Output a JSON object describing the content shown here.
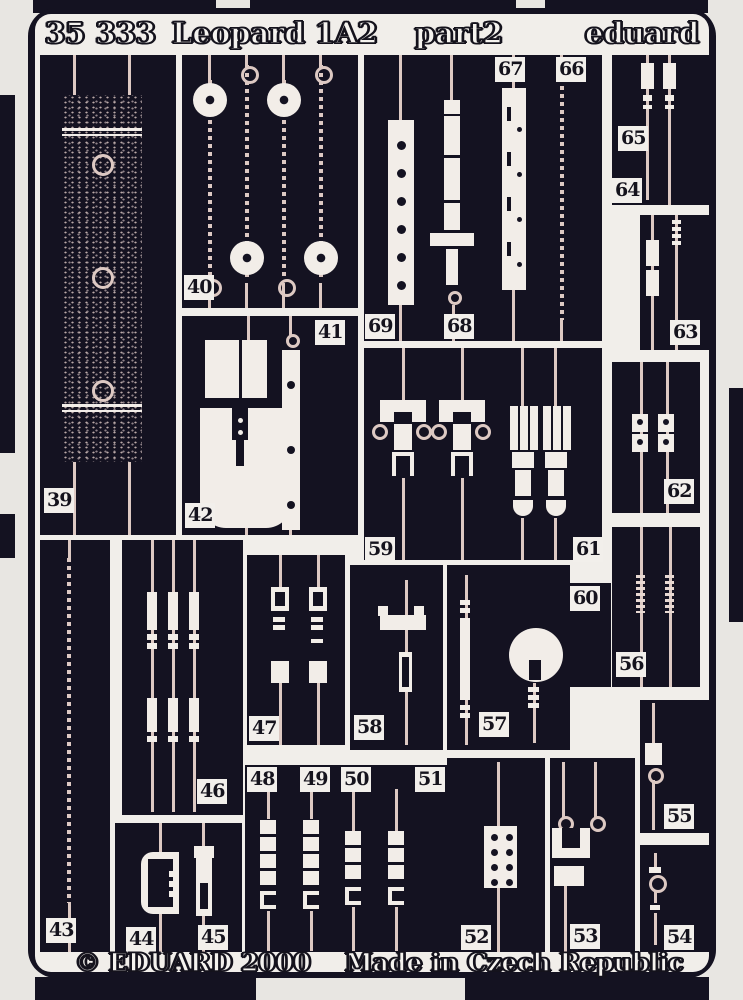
{
  "header": {
    "catalog_number": "35 333",
    "kit_name": "Leopard 1A2",
    "part_label": "part2",
    "brand": "eduard"
  },
  "footer": {
    "copyright": "© EDUARD 2000",
    "origin": "Made in Czech Republic"
  },
  "colors": {
    "fret_dark": "#141221",
    "cutout_white": "#f1eeea",
    "metal_tint": "#ddc9c3",
    "background": "#e8e6e2"
  },
  "parts": {
    "p39": "39",
    "p40": "40",
    "p41": "41",
    "p42": "42",
    "p43": "43",
    "p44": "44",
    "p45": "45",
    "p46": "46",
    "p47": "47",
    "p48": "48",
    "p49": "49",
    "p50": "50",
    "p51": "51",
    "p52": "52",
    "p53": "53",
    "p54": "54",
    "p55": "55",
    "p56": "56",
    "p57": "57",
    "p58": "58",
    "p59": "59",
    "p60": "60",
    "p61": "61",
    "p62": "62",
    "p63": "63",
    "p64": "64",
    "p65": "65",
    "p66": "66",
    "p67": "67",
    "p68": "68",
    "p69": "69"
  }
}
